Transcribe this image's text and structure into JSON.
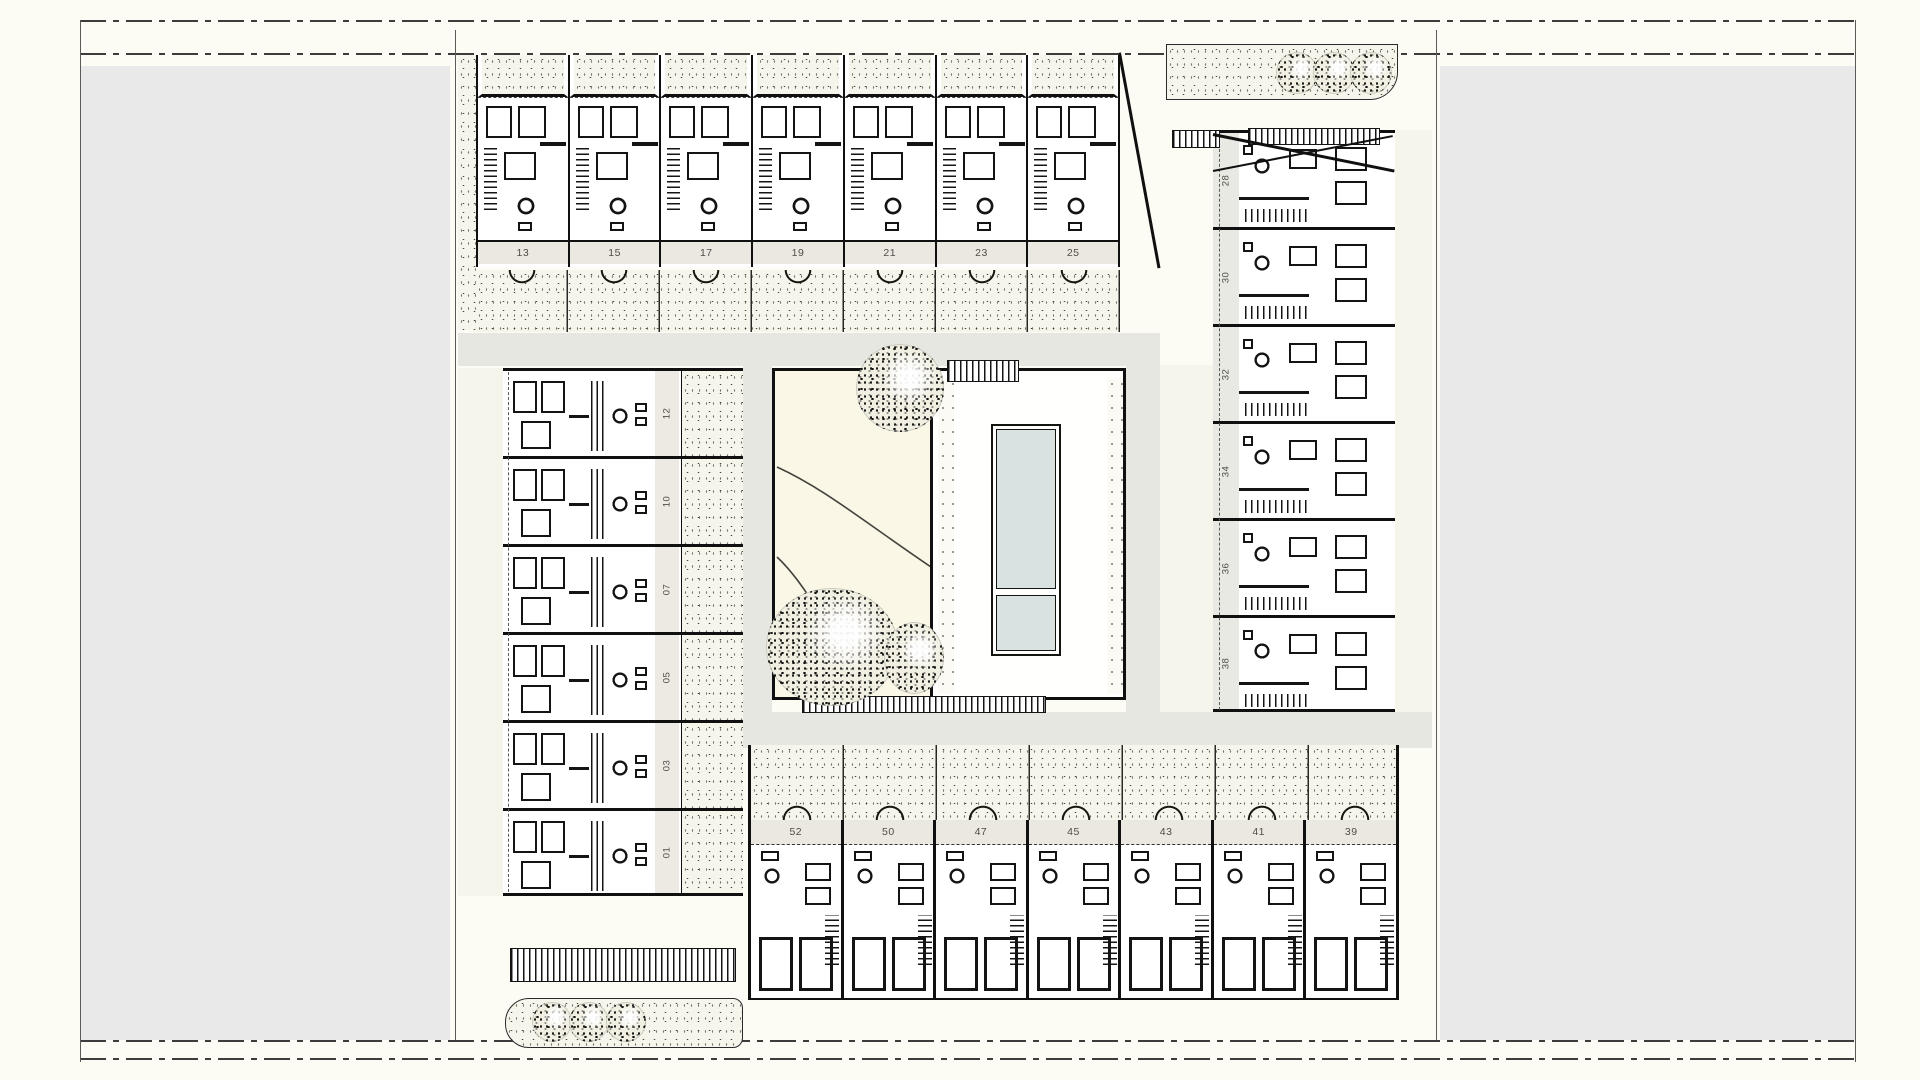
{
  "drawing": {
    "type": "architectural-site-plan",
    "unit_rows": {
      "top": [
        "13",
        "15",
        "17",
        "19",
        "21",
        "23",
        "25"
      ],
      "left": [
        "12",
        "10",
        "07",
        "05",
        "03",
        "01"
      ],
      "right": [
        "28",
        "30",
        "32",
        "34",
        "36",
        "38"
      ],
      "bottom": [
        "52",
        "50",
        "47",
        "45",
        "43",
        "41",
        "39"
      ]
    },
    "tree_groups": {
      "top_right": 3,
      "bottom_left": 3,
      "courtyard": 3
    },
    "colors": {
      "paper": "#fcfbf4",
      "side_panels": "#e9e9e9",
      "walkway": "#e7e7e2",
      "planting": "#f6f5ec",
      "label_strip": "#eae8e0",
      "courtyard": "#faf7e6",
      "pool_water": "#d9e2e1",
      "ink": "#141414"
    }
  }
}
